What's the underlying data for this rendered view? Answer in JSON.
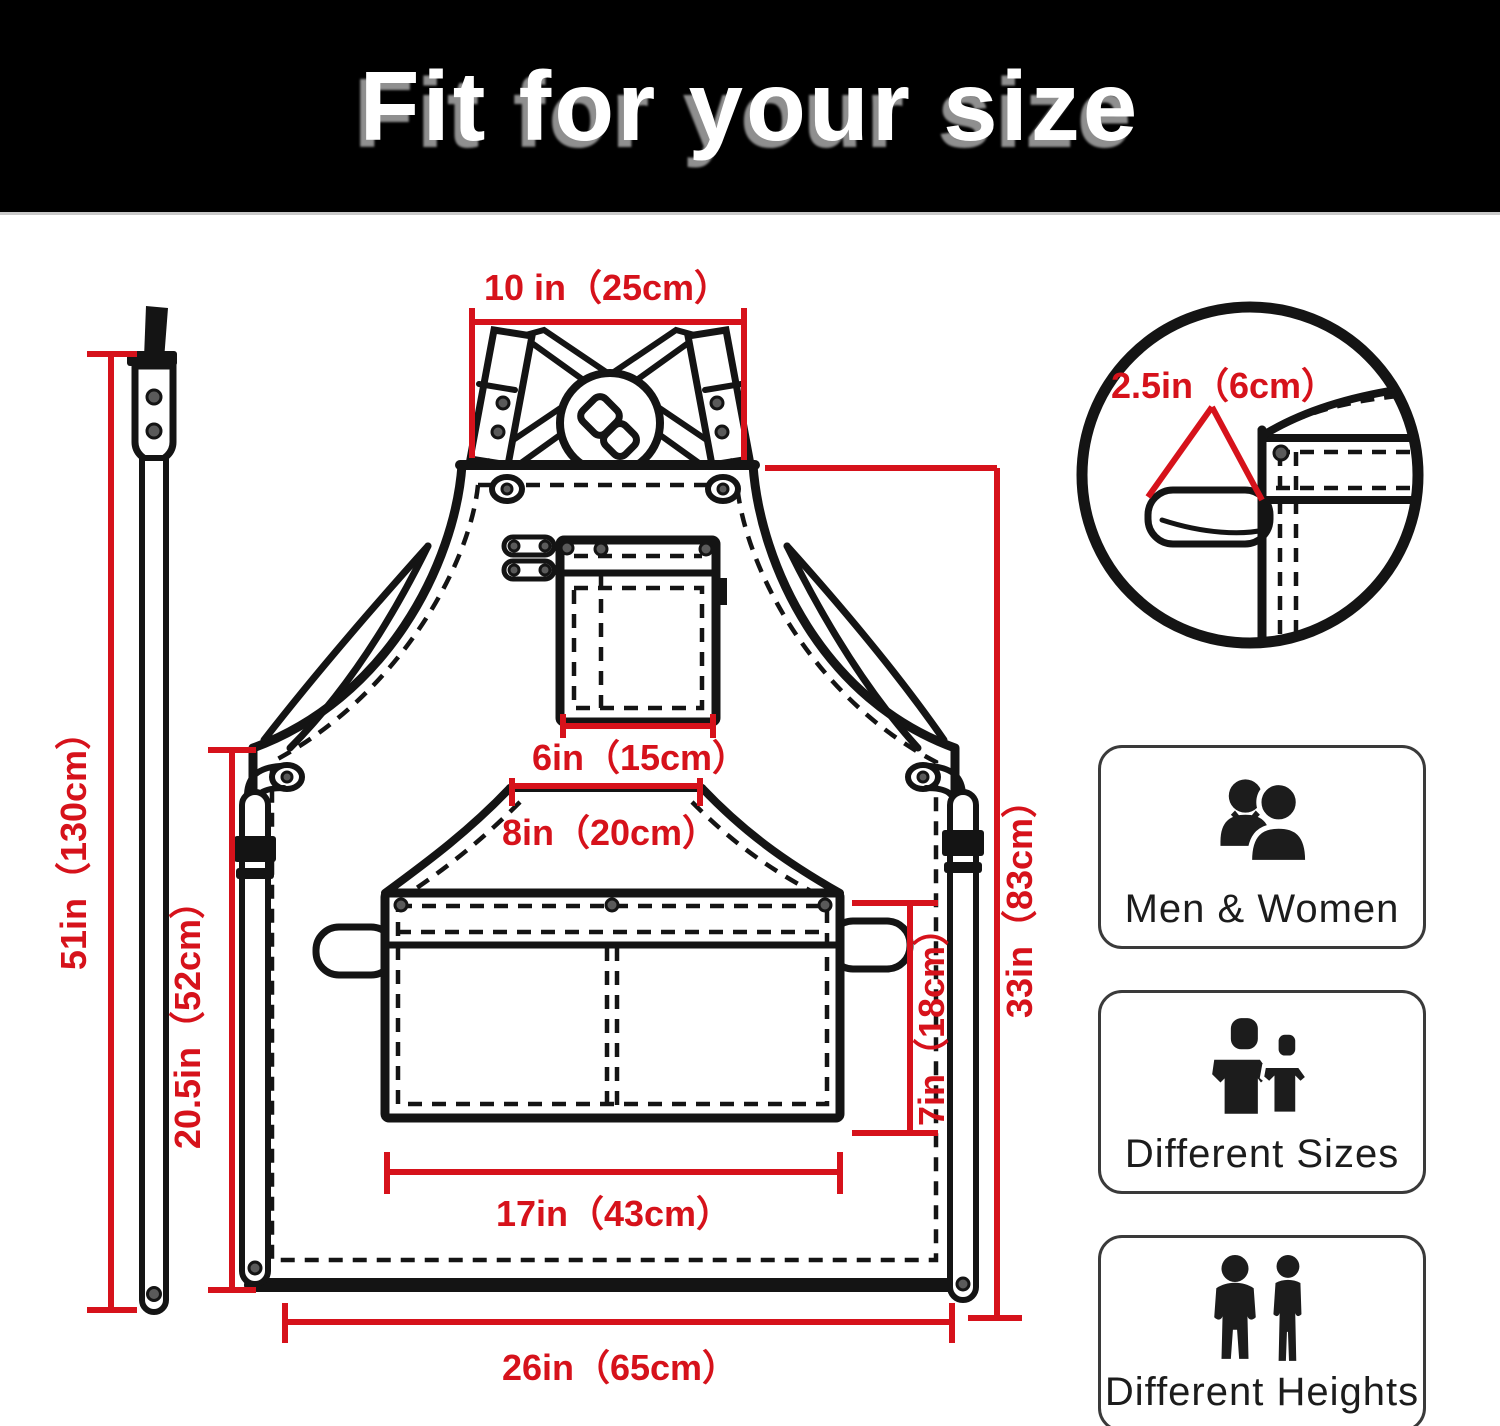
{
  "header": {
    "title": "Fit for your size"
  },
  "colors": {
    "header_bg": "#000000",
    "title_text": "#ffffff",
    "title_shadow": "#8f8f8f",
    "dimension_red": "#d6121b",
    "line_black": "#141414",
    "badge_border": "#3a3a3a"
  },
  "apron_diagram": {
    "dimensions": {
      "neck_strap_width": "10 in（25cm）",
      "hanging_strap_length": "51in（130cm）",
      "loop_size": "2.5in（6cm）",
      "side_length": "20.5in（52cm）",
      "chest_pocket_width": "6in（15cm）",
      "mid_panel_width": "8in（20cm）",
      "waist_pocket_width": "17in（43cm）",
      "waist_pocket_height": "7in（18cm）",
      "body_length": "33in（83cm）",
      "bottom_width": "26in（65cm）"
    }
  },
  "features": [
    {
      "label": "Men & Women",
      "icon": "men-women-icon"
    },
    {
      "label": "Different Sizes",
      "icon": "different-sizes-icon"
    },
    {
      "label": "Different Heights",
      "icon": "different-heights-icon"
    }
  ]
}
